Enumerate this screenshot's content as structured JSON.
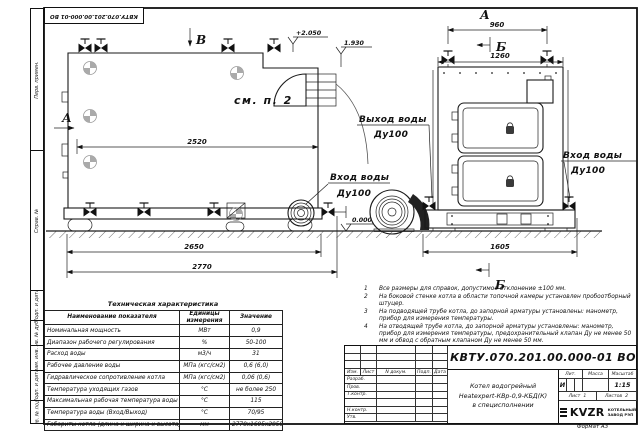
{
  "top_designation": "КВТУ.070.201.00.000-01 ВО",
  "stamp_margin": {
    "cells": [
      "Перв. примен.",
      "Справ. №",
      "Подп. и дата",
      "Инв. № дубл.",
      "Взам. инв. №",
      "Подп. и дата",
      "Инв. № подл."
    ]
  },
  "drawing": {
    "view_labels": {
      "b": "В",
      "a": "А",
      "sec_b": "Б"
    },
    "note_ref": "см. п. 2",
    "levels": {
      "top": "+2.050",
      "flue": "1.930",
      "zero": "0.000"
    },
    "dimensions": {
      "boiler_length": "2520",
      "base_length": "2650",
      "overall_length": "2770",
      "top_valves_span": "960",
      "front_width": "1260",
      "front_base": "1605"
    },
    "ports": {
      "outlet_label": "Выход воды",
      "outlet_dn": "Ду100",
      "inlet_side_label": "Вход воды",
      "inlet_side_dn": "Ду100",
      "inlet_front_label": "Вход воды",
      "inlet_front_dn": "Ду100"
    }
  },
  "tech_table": {
    "title": "Техническая характеристика",
    "headers": [
      "Наименование показателя",
      "Единицы измерения",
      "Значение"
    ],
    "rows": [
      [
        "Номинальная мощность",
        "МВт",
        "0,9"
      ],
      [
        "Диапазон рабочего регулирования",
        "%",
        "50-100"
      ],
      [
        "Расход воды",
        "м3/ч",
        "31"
      ],
      [
        "Рабочее давление воды",
        "МПа (кгс/см2)",
        "0,6 (6,0)"
      ],
      [
        "Гидравлическое сопротивление котла",
        "МПа (кгс/см2)",
        "0,06 (0,6)"
      ],
      [
        "Температура уходящих газов",
        "°С",
        "не более 250"
      ],
      [
        "Максимальная рабочая температура воды",
        "°С",
        "115"
      ],
      [
        "Температура воды (Вход/Выход)",
        "°С",
        "70/95"
      ],
      [
        "Габариты котла (длина х ширина х высота)",
        "мм",
        "2770х1605х2050"
      ]
    ]
  },
  "notes": {
    "items": [
      {
        "n": "1",
        "text": "Все размеры для справок, допустимое отклонение ±100 мм."
      },
      {
        "n": "2",
        "text": "На боковой стенке котла в области топочной камеры установлен пробоотборный штуцер."
      },
      {
        "n": "3",
        "text": "На подводящей трубе котла, до запорной арматуры установлены: манометр, прибор для измерения температуры."
      },
      {
        "n": "4",
        "text": "На отводящей трубе котла, до запорной арматуры установлены: манометр, прибор для измерения температуры, предохранительный клапан Ду не менее 50 мм и обвод с обратным клапаном Ду не менее 50 мм."
      }
    ]
  },
  "title_block": {
    "designation": "КВТУ.070.201.00.000-01 ВО",
    "doc_name": [
      "Котел водогрейный",
      "Heatexpert-КВр-0,9-КБД(К)",
      "в специсполнении"
    ],
    "cols": [
      "Изм.",
      "Лист",
      "N докум.",
      "Подп.",
      "Дата"
    ],
    "rows": [
      "Разраб.",
      "Пров.",
      "Т.контр.",
      "",
      "Н.контр.",
      "Утв."
    ],
    "lit_label": "Лит.",
    "mass_label": "Масса",
    "scale_label": "Масштаб",
    "lit_value": "И",
    "scale_value": "1:15",
    "sheet_label": "Лист",
    "sheet_num": "1",
    "sheets_label": "Листов",
    "sheets_num": "2",
    "logo_text": "KVZR",
    "logo_caption_1": "КОТЕЛЬНЫЙ",
    "logo_caption_2": "ЗАВОД РЭП",
    "format_note": "Формат А3"
  }
}
